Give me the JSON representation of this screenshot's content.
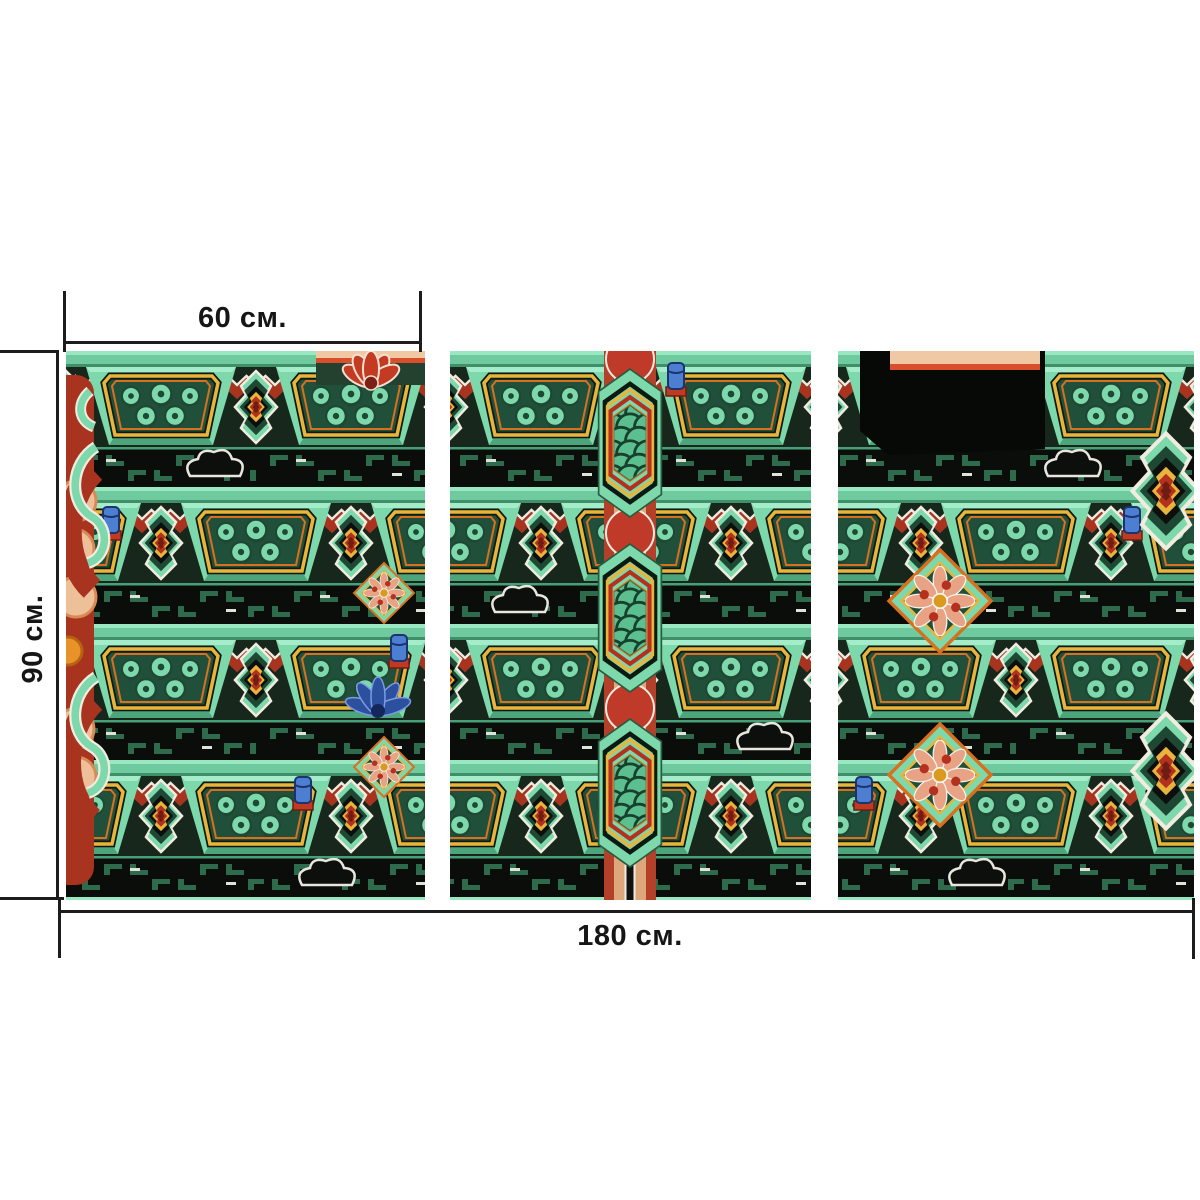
{
  "mockup": {
    "description": "Triptych modular canvas print mockup of a Korean temple dancheong-painted ceiling with ornate interlocking mint-green brackets, red and yellow chevrons, cloud scrolls and lotus medallions",
    "panel_count": 3,
    "panels": [
      {
        "id": "left",
        "alt": "left panel: red side bracket with green curls and bracket rows"
      },
      {
        "id": "center",
        "alt": "center panel: painted column with wave-scale capitals"
      },
      {
        "id": "right",
        "alt": "right panel: bracket clusters, dark recess and flower medallions"
      }
    ]
  },
  "dimensions": {
    "panel_width_label": "60 см.",
    "height_label": "90 см.",
    "total_width_label": "180 см."
  },
  "style": {
    "background": "#ffffff",
    "dimension_line_color": "#1c1c1c",
    "artwork_palette": {
      "mint_green": "#7dd8ab",
      "deep_green": "#1e4734",
      "mid_green": "#2e6a4c",
      "red": "#b43120",
      "dark_red": "#6f1d12",
      "orange": "#d8701f",
      "yellow": "#e9b43b",
      "salmon": "#f0c8a4",
      "blue": "#4c7fd2",
      "near_black": "#0c0f0b",
      "white": "#f2ece0"
    }
  }
}
